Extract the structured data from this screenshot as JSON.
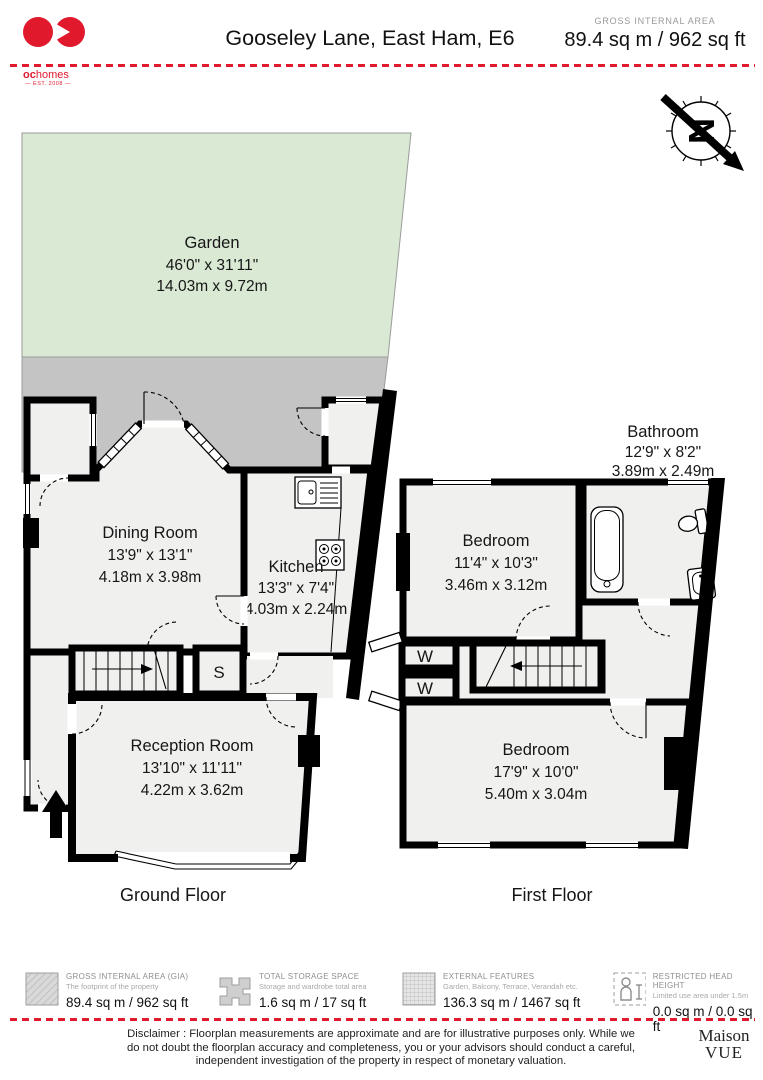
{
  "header": {
    "brand_bold": "oc",
    "brand_rest": "homes",
    "brand_est": "— EST. 2008 —",
    "title": "Gooseley Lane, East Ham, E6",
    "area_label": "GROSS INTERNAL AREA",
    "area_value": "89.4 sq m / 962 sq ft"
  },
  "compass": {
    "letter": "N"
  },
  "ground_floor": {
    "label": "Ground Floor",
    "garden": {
      "name": "Garden",
      "imperial": "46'0\" x 31'11\"",
      "metric": "14.03m x 9.72m"
    },
    "dining": {
      "name": "Dining Room",
      "imperial": "13'9\" x 13'1\"",
      "metric": "4.18m x 3.98m"
    },
    "kitchen": {
      "name": "Kitchen",
      "imperial": "13'3\" x 7'4\"",
      "metric": "4.03m x 2.24m"
    },
    "reception": {
      "name": "Reception Room",
      "imperial": "13'10\" x 11'11\"",
      "metric": "4.22m x 3.62m"
    },
    "storage_letter": "S"
  },
  "first_floor": {
    "label": "First Floor",
    "bathroom": {
      "name": "Bathroom",
      "imperial": "12'9\" x 8'2\"",
      "metric": "3.89m x 2.49m"
    },
    "bedroom1": {
      "name": "Bedroom",
      "imperial": "11'4\" x 10'3\"",
      "metric": "3.46m x 3.12m"
    },
    "bedroom2": {
      "name": "Bedroom",
      "imperial": "17'9\" x 10'0\"",
      "metric": "5.40m x 3.04m"
    },
    "wardrobe_letter": "W"
  },
  "legend": [
    {
      "title": "GROSS INTERNAL AREA (GIA)",
      "subtitle": "The footprint of the property",
      "value": "89.4 sq m / 962 sq ft"
    },
    {
      "title": "TOTAL STORAGE SPACE",
      "subtitle": "Storage and wardrobe total area",
      "value": "1.6 sq m / 17 sq ft"
    },
    {
      "title": "EXTERNAL FEATURES",
      "subtitle": "Garden, Balcony, Terrace, Verandah etc.",
      "value": "136.3 sq m / 1467 sq ft"
    },
    {
      "title": "RESTRICTED HEAD HEIGHT",
      "subtitle": "Limited use area under 1.5m",
      "value": "0.0 sq m / 0.0 sq ft"
    }
  ],
  "footer": {
    "disclaimer": "Disclaimer : Floorplan measurements are approximate and are for illustrative purposes only. While we do not doubt the floorplan accuracy and completeness, you or your advisors should conduct a careful, independent investigation of the property in respect of monetary valuation.",
    "brand_top": "Maison",
    "brand_bottom": "VUE"
  },
  "colors": {
    "accent_red": "#e0192d",
    "garden_green": "#d9e9d4",
    "patio_grey": "#c4c4c4",
    "room_fill": "#f0f0ef",
    "wall": "#000000"
  }
}
